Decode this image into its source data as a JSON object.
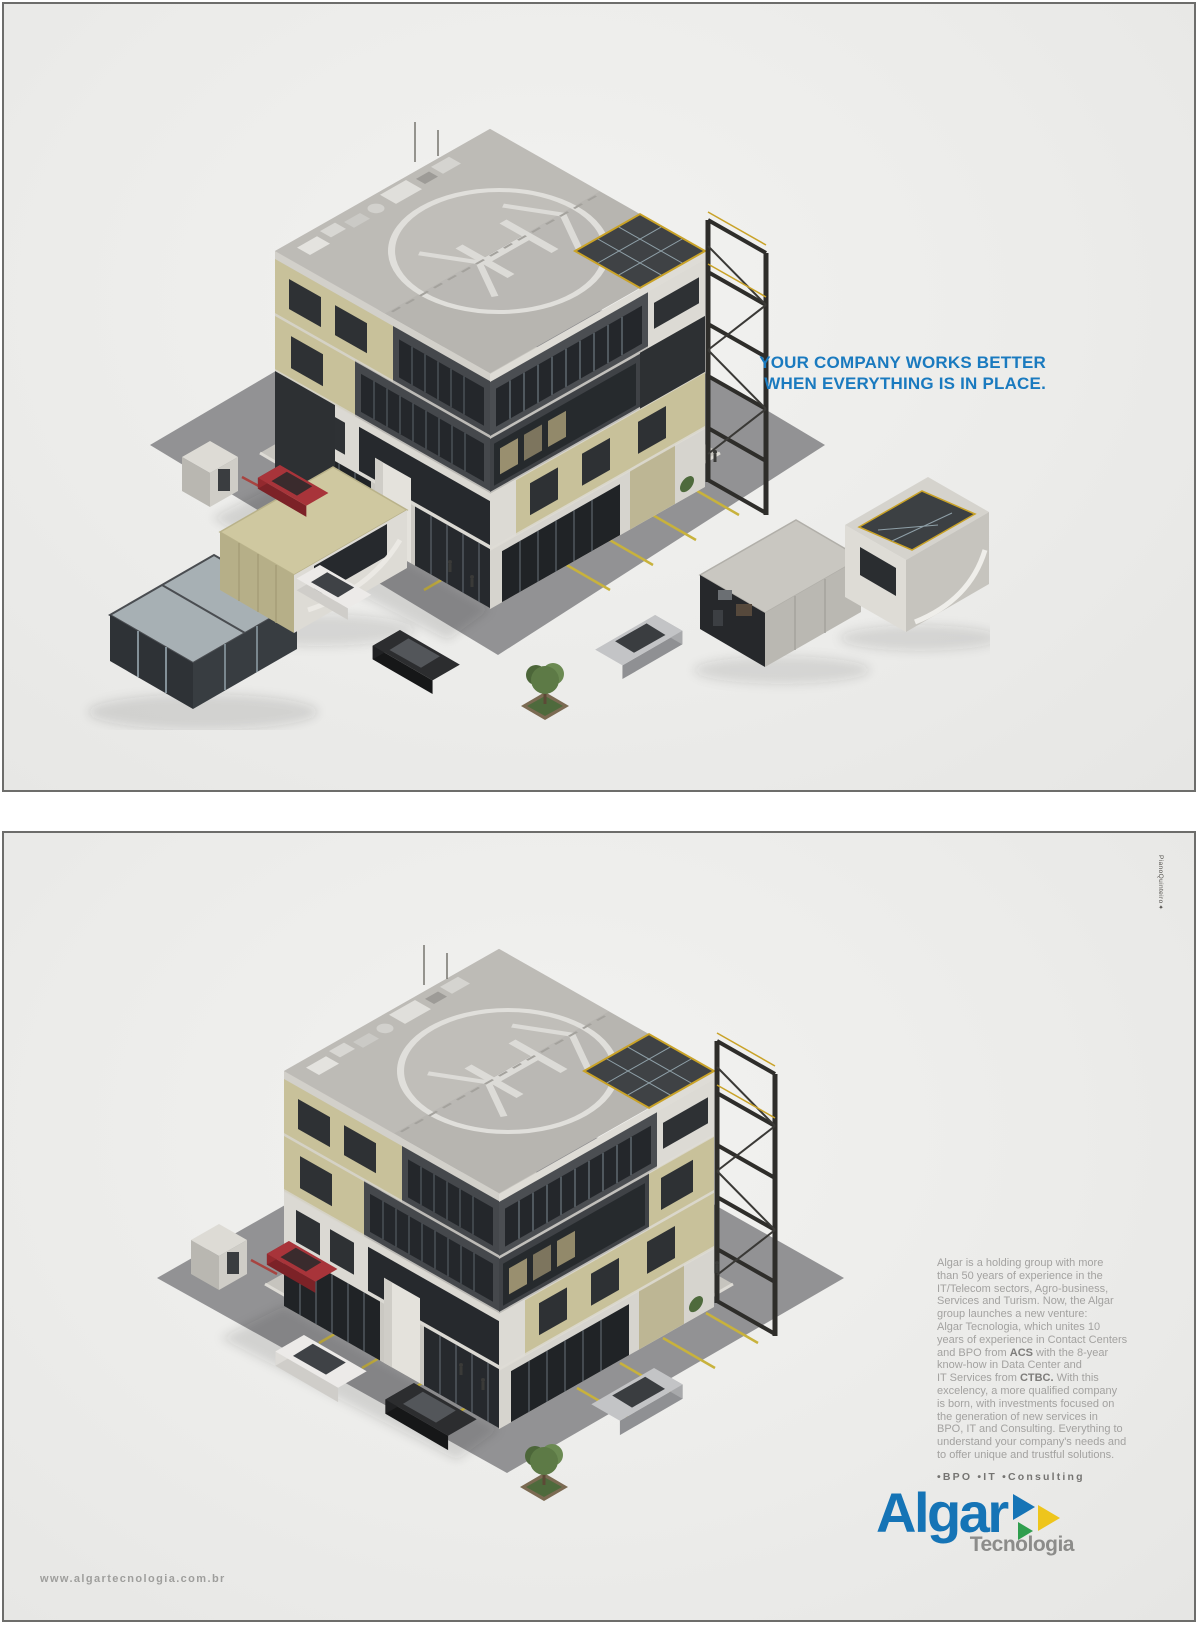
{
  "panel_top": {
    "headline_line1": "YOUR COMPANY WORKS BETTER",
    "headline_line2": "WHEN EVERYTHING IS IN PLACE.",
    "headline_color": "#1a7abf",
    "illustration": "office building disassembled into scattered modules around a parking lot"
  },
  "panel_bottom": {
    "illustration": "same office building fully assembled with helipad roof and parking lot",
    "body_lines": [
      [
        {
          "t": "Algar is a holding group with more"
        }
      ],
      [
        {
          "t": "than 50 years of experience in the"
        }
      ],
      [
        {
          "t": "IT/Telecom sectors, Agro-business,"
        }
      ],
      [
        {
          "t": "Services and Turism. Now, the Algar"
        }
      ],
      [
        {
          "t": "group launches a new venture:"
        }
      ],
      [
        {
          "t": "Algar Tecnologia, which unites 10"
        }
      ],
      [
        {
          "t": "years of experience in Contact Centers"
        }
      ],
      [
        {
          "t": "and BPO from "
        },
        {
          "t": "ACS",
          "b": true
        },
        {
          "t": " with the 8-year"
        }
      ],
      [
        {
          "t": "know-how in Data Center and"
        }
      ],
      [
        {
          "t": "IT Services from "
        },
        {
          "t": "CTBC.",
          "b": true
        },
        {
          "t": " With this"
        }
      ],
      [
        {
          "t": "excelency, a more qualified company"
        }
      ],
      [
        {
          "t": "is born, with investments focused on"
        }
      ],
      [
        {
          "t": "the generation of new services in"
        }
      ],
      [
        {
          "t": "BPO, IT and Consulting. Everything to"
        }
      ],
      [
        {
          "t": "understand your company's needs and"
        }
      ],
      [
        {
          "t": "to offer unique and trustful solutions."
        }
      ]
    ],
    "services_line": "•BPO  •IT  •Consulting",
    "url": "www.algartecnologia.com.br",
    "credit_vertical": "PianoQuinteiro✦"
  },
  "logo": {
    "wordmark": "Algar",
    "subbrand": "Tecnologia",
    "blue": "#1574b6",
    "yellow": "#eec51c",
    "green": "#2f9e4e",
    "gray": "#8c8c8a"
  }
}
